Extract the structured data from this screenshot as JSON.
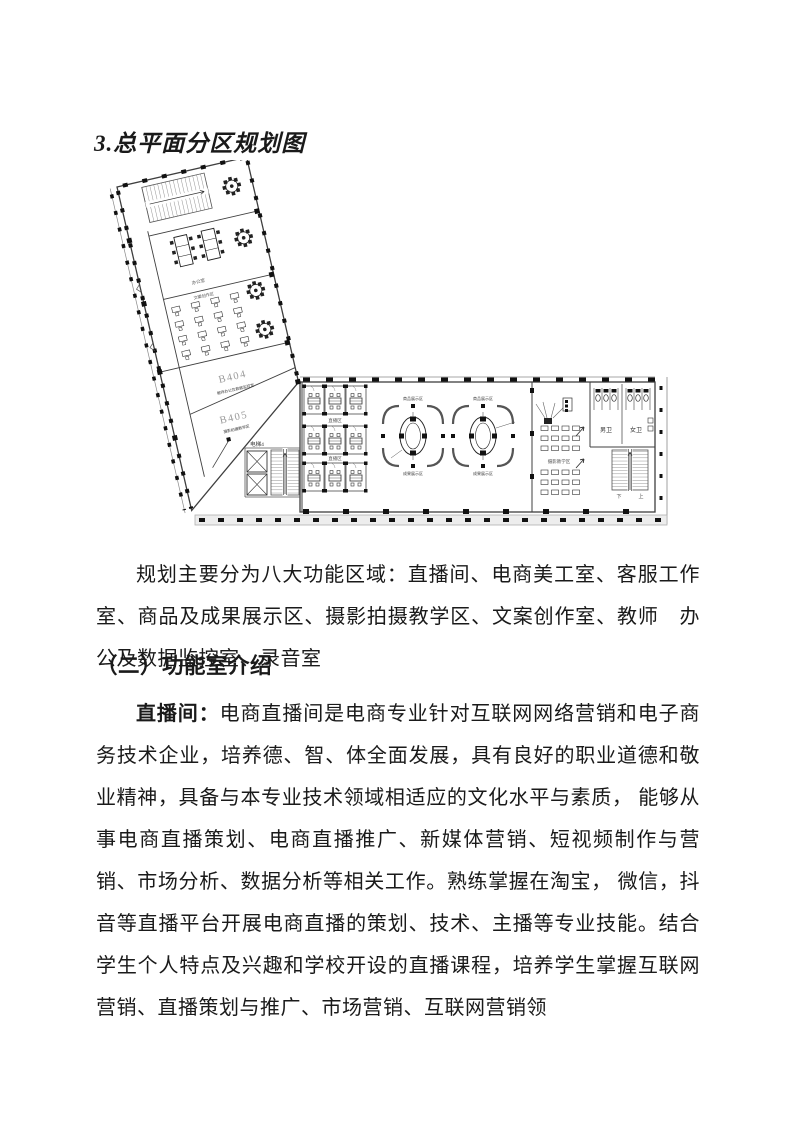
{
  "document": {
    "heading_plan": "3.总平面分区规划图",
    "para_zones": "规划主要分为八大功能区域：直播间、电商美工室、客服工作室、商品及成果展示区、摄影拍摄教学区、文案创作室、教师　办公及数据监控室、录音室",
    "heading_intro": "（二）功能室介绍",
    "para_live_lead": "直播间：",
    "para_live_body": "电商直播间是电商专业针对互联网网络营销和电子商务技术企业，培养德、智、体全面发展，具有良好的职业道德和敬业精神，具备与本专业技术领域相适应的文化水平与素质， 能够从事电商直播策划、电商直播推广、新媒体营销、短视频制作与营销、市场分析、数据分析等相关工作。熟练掌握在淘宝， 微信，抖音等直播平台开展电商直播的策划、技术、主播等专业技能。结合学生个人特点及兴趣和学校开设的直播课程，培养学生掌握互联网营销、直播策划与推广、市场营销、互联网营销领"
  },
  "floorplan": {
    "room_b404": "B404",
    "room_b404_sub": "教师办公及数据监控室",
    "room_b405": "B405",
    "room_b405_sub": "摄影拍摄教学区",
    "elevator": "电梯4",
    "mens_toilet": "男卫",
    "womens_toilet": "女卫",
    "live_zone": "直播区",
    "display_zone": "商品展示区",
    "display_zone2": "成果展示区",
    "media_teaching_zone": "摄影教学区",
    "copywriting_zone": "文案创作区",
    "office": "办公室",
    "stairs_down": "下",
    "stairs_up": "上"
  },
  "colors": {
    "page_bg": "#ffffff",
    "wall_line": "#3f3f3f",
    "light_line": "#8a8a8a",
    "column_fill": "#111111",
    "room_code_text": "#9a9a9a",
    "balcony_strip": "#ededed"
  }
}
